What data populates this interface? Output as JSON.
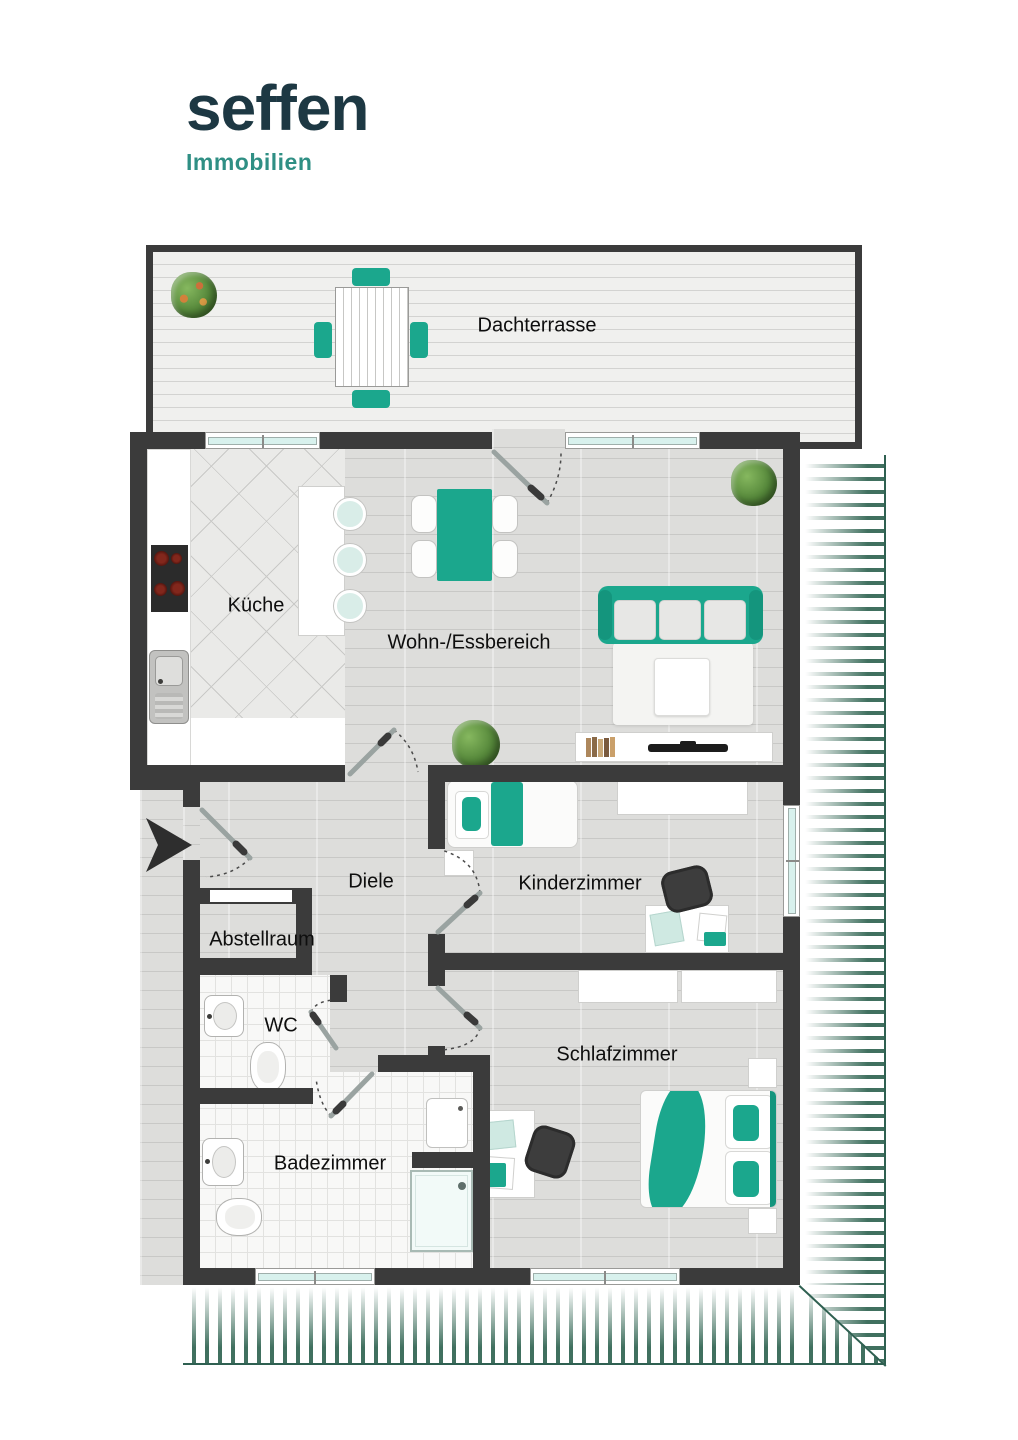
{
  "brand": {
    "name": "seffen",
    "subtitle": "Immobilien"
  },
  "rooms": {
    "dachterrasse": {
      "label": "Dachterrasse"
    },
    "kueche": {
      "label": "Küche"
    },
    "wohnessbereich": {
      "label": "Wohn-/Essbereich"
    },
    "diele": {
      "label": "Diele"
    },
    "kinderzimmer": {
      "label": "Kinderzimmer"
    },
    "abstellraum": {
      "label": "Abstellraum"
    },
    "wc": {
      "label": "WC"
    },
    "badezimmer": {
      "label": "Badezimmer"
    },
    "schlafzimmer": {
      "label": "Schlafzimmer"
    }
  },
  "colors": {
    "accent_teal": "#1ba78d",
    "wall_dark": "#3b3b3b",
    "logo_navy": "#1d3843",
    "logo_teal": "#2f8f84",
    "hatch_green": "#40705f",
    "window_glass": "#d8f1ed"
  }
}
